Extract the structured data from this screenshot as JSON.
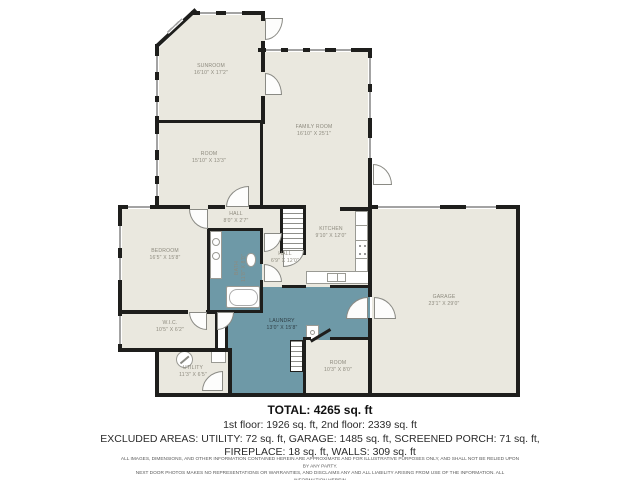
{
  "colors": {
    "wall": "#1e1e1c",
    "floor": "#eae8df",
    "wet": "#6e99a7"
  },
  "rooms": {
    "sunroom": {
      "label": "SUNROOM",
      "dims": "16'10\" X 17'2\""
    },
    "family": {
      "label": "FAMILY ROOM",
      "dims": "16'10\" X 25'1\""
    },
    "room_upper": {
      "label": "ROOM",
      "dims": "15'10\" X 13'3\""
    },
    "hall_upper": {
      "label": "HALL",
      "dims": "8'0\" X 2'7\""
    },
    "bedroom": {
      "label": "BEDROOM",
      "dims": "16'5\" X 15'8\""
    },
    "bath": {
      "label": "BATH",
      "dims": "11'8\" X 8'0\""
    },
    "hall_lower": {
      "label": "HALL",
      "dims": "6'9\" X 12'0\""
    },
    "kitchen": {
      "label": "KITCHEN",
      "dims": "9'10\" X 12'0\""
    },
    "garage": {
      "label": "GARAGE",
      "dims": "23'1\" X 29'0\""
    },
    "laundry": {
      "label": "LAUNDRY",
      "dims": "13'0\" X 15'8\""
    },
    "room_lower": {
      "label": "ROOM",
      "dims": "10'3\" X 8'0\""
    },
    "wic": {
      "label": "W.I.C.",
      "dims": "10'5\" X 6'2\""
    },
    "utility": {
      "label": "UTILITY",
      "dims": "11'3\" X 6'5\""
    }
  },
  "summary": {
    "total": "TOTAL: 4265 sq. ft",
    "floors": "1st floor: 1926 sq. ft, 2nd floor: 2339 sq. ft",
    "excluded_1": "EXCLUDED AREAS: UTILITY: 72 sq. ft, GARAGE: 1485 sq. ft, SCREENED PORCH: 71 sq. ft,",
    "excluded_2": "FIREPLACE: 18 sq. ft, WALLS: 309 sq. ft",
    "disclaimer_1": "ALL IMAGES, DIMENSIONS, AND OTHER INFORMATION CONTAINED HEREIN ARE APPROXIMATE AND FOR ILLUSTRATIVE PURPOSES ONLY, AND SHALL NOT BE RELIED UPON BY ANY PARTY.",
    "disclaimer_2": "NEXT DOOR PHOTOS MAKES NO REPRESENTATIONS OR WARRANTIES, AND DISCLAIMS ANY AND ALL LIABILITY ARISING FROM USE OF THE INFORMATION. ALL INFORMATION HEREIN",
    "disclaimer_3": "SHALL BE SUBJECT TO THE TERMS AND CONDITIONS FOUND AT NEXTDOORPHOTOS.COM/FP."
  }
}
